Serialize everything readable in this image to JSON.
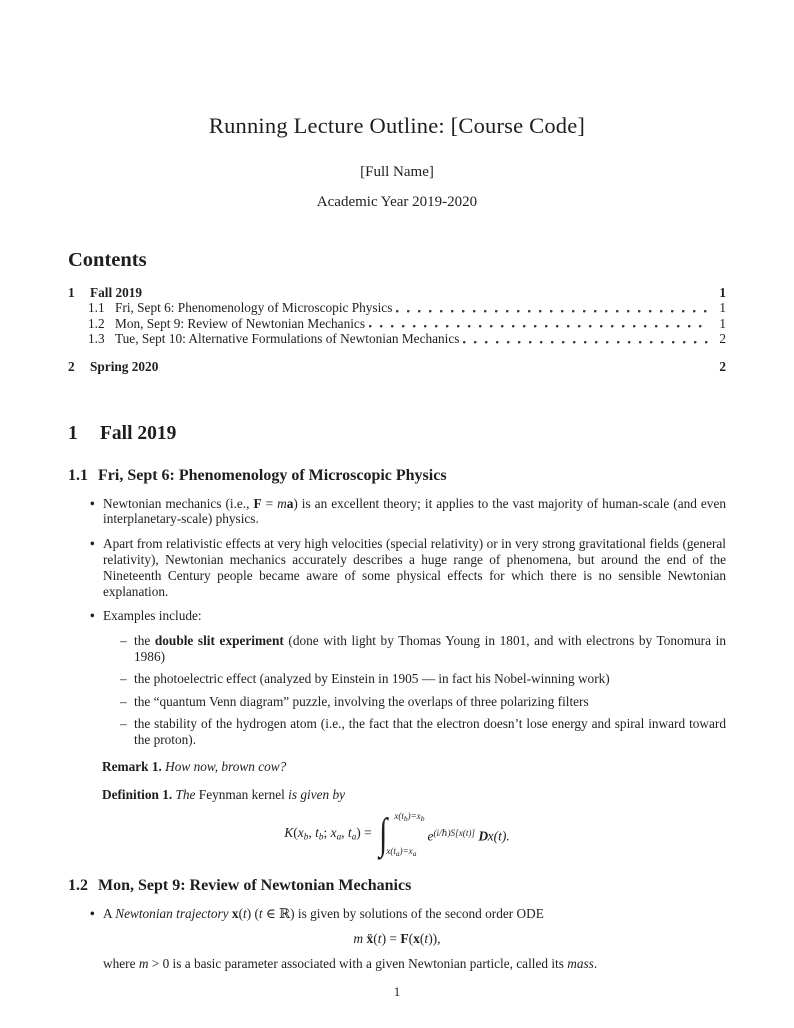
{
  "marks": {
    "bullet": "•",
    "dash": "–"
  },
  "header": {
    "title": "Running Lecture Outline: [Course Code]",
    "author": "[Full Name]",
    "date_line": "Academic Year 2019-2020"
  },
  "contents": {
    "heading": "Contents",
    "entries": [
      {
        "num": "1",
        "label": "Fall 2019",
        "page": "1"
      },
      {
        "num": "1.1",
        "label": "Fri, Sept 6: Phenomenology of Microscopic Physics",
        "page": "1"
      },
      {
        "num": "1.2",
        "label": "Mon, Sept 9: Review of Newtonian Mechanics",
        "page": "1"
      },
      {
        "num": "1.3",
        "label": "Tue, Sept 10: Alternative Formulations of Newtonian Mechanics",
        "page": "2"
      },
      {
        "num": "2",
        "label": "Spring 2020",
        "page": "2"
      }
    ]
  },
  "section1": {
    "num": "1",
    "title": "Fall 2019"
  },
  "sec11": {
    "num": "1.1",
    "title": "Fri, Sept 6: Phenomenology of Microscopic Physics",
    "bullets": [
      [
        {
          "t": "Newtonian mechanics (i.e., "
        },
        {
          "t": "F",
          "s": "b"
        },
        {
          "t": " = "
        },
        {
          "t": "m",
          "s": "i"
        },
        {
          "t": "a",
          "s": "b"
        },
        {
          "t": ") is an excellent theory; it applies to the vast majority of human-scale (and even interplanetary-scale) physics."
        }
      ],
      [
        {
          "t": "Apart from relativistic effects at very high velocities (special relativity) or in very strong gravitational fields (general relativity), Newtonian mechanics accurately describes a huge range of phenomena, but around the end of the Nineteenth Century people became aware of some physical effects for which there is no sensible Newtonian explanation."
        }
      ],
      [
        {
          "t": "Examples include:"
        }
      ]
    ],
    "examples": [
      [
        {
          "t": "the "
        },
        {
          "t": "double slit experiment",
          "s": "b"
        },
        {
          "t": " (done with light by Thomas Young in 1801, and with electrons by Tonomura in 1986)"
        }
      ],
      [
        {
          "t": "the photoelectric effect (analyzed by Einstein in 1905 — in fact his Nobel-winning work)"
        }
      ],
      [
        {
          "t": "the “quantum Venn diagram” puzzle, involving the overlaps of three polarizing filters"
        }
      ],
      [
        {
          "t": "the stability of the hydrogen atom (i.e., the fact that the electron doesn’t lose energy and spiral inward toward the proton)."
        }
      ]
    ],
    "remark": {
      "label": "Remark 1.",
      "body": [
        {
          "t": "How now, brown cow?",
          "s": "i"
        }
      ]
    },
    "definition": {
      "label": "Definition 1.",
      "body": [
        {
          "t": "The ",
          "s": "i"
        },
        {
          "t": "Feynman kernel"
        },
        {
          "t": " is given by",
          "s": "i"
        }
      ],
      "formula": {
        "lhs": [
          {
            "t": "K",
            "s": "i"
          },
          {
            "t": "("
          },
          {
            "t": "x",
            "s": "i"
          },
          {
            "t": "b",
            "s": "sub"
          },
          {
            "t": ", t",
            "s": "i"
          },
          {
            "t": "b",
            "s": "sub"
          },
          {
            "t": "; "
          },
          {
            "t": "x",
            "s": "i"
          },
          {
            "t": "a",
            "s": "sub"
          },
          {
            "t": ", t",
            "s": "i"
          },
          {
            "t": "a",
            "s": "sub"
          },
          {
            "t": ") = "
          }
        ],
        "integral_sign": "∫",
        "upper_limit": [
          {
            "t": "x(t",
            "s": "i"
          },
          {
            "t": "b",
            "s": "sub"
          },
          {
            "t": ")=x",
            "s": "i"
          },
          {
            "t": "b",
            "s": "sub"
          }
        ],
        "lower_limit": [
          {
            "t": "x(t",
            "s": "i"
          },
          {
            "t": "a",
            "s": "sub"
          },
          {
            "t": ")=x",
            "s": "i"
          },
          {
            "t": "a",
            "s": "sub"
          }
        ],
        "rhs": [
          {
            "t": "e",
            "s": "i"
          },
          {
            "t": "(i/ℏ)S[x(t)]",
            "s": "sup"
          },
          {
            "t": " "
          },
          {
            "t": "D",
            "s": "scr"
          },
          {
            "t": "x",
            "s": "i"
          },
          {
            "t": "(t).",
            "s": "i"
          }
        ]
      }
    }
  },
  "sec12": {
    "num": "1.2",
    "title": "Mon, Sept 9: Review of Newtonian Mechanics",
    "bullet": [
      {
        "t": "A "
      },
      {
        "t": "Newtonian trajectory",
        "s": "i"
      },
      {
        "t": " "
      },
      {
        "t": "x",
        "s": "b"
      },
      {
        "t": "("
      },
      {
        "t": "t",
        "s": "i"
      },
      {
        "t": ") ("
      },
      {
        "t": "t",
        "s": "i"
      },
      {
        "t": " ∈ ℝ) is given by solutions of the second order ODE"
      }
    ],
    "equation": [
      {
        "t": "m",
        "s": "i"
      },
      {
        "t": " "
      },
      {
        "t": "ẍ",
        "s": "b"
      },
      {
        "t": "("
      },
      {
        "t": "t",
        "s": "i"
      },
      {
        "t": ") = "
      },
      {
        "t": "F",
        "s": "b"
      },
      {
        "t": "("
      },
      {
        "t": "x",
        "s": "b"
      },
      {
        "t": "("
      },
      {
        "t": "t",
        "s": "i"
      },
      {
        "t": ")),"
      }
    ],
    "continuation": [
      {
        "t": "where "
      },
      {
        "t": "m",
        "s": "i"
      },
      {
        "t": " > 0 is a basic parameter associated with a given Newtonian particle, called its "
      },
      {
        "t": "mass",
        "s": "i"
      },
      {
        "t": "."
      }
    ]
  },
  "footer": {
    "page_number": "1"
  }
}
